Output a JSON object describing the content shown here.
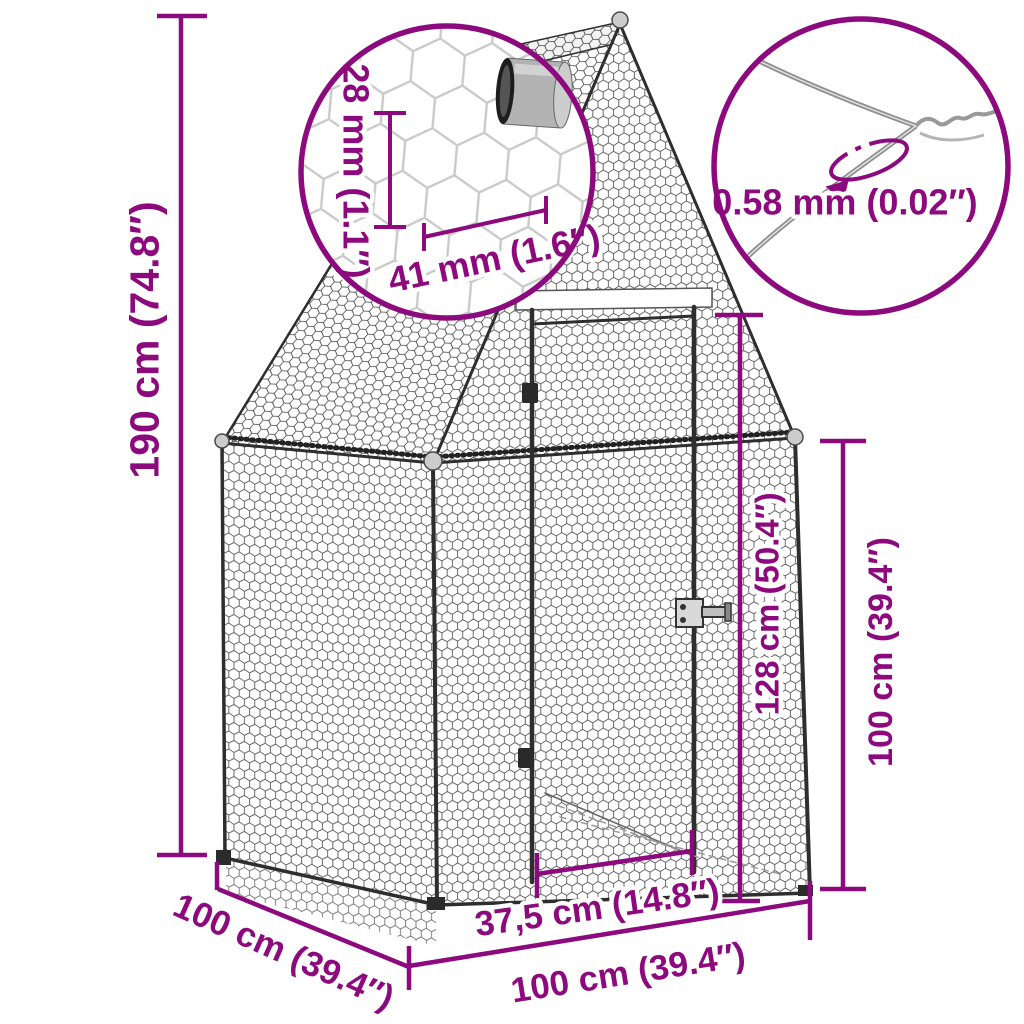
{
  "accent_color": "#8C0A7D",
  "callout_mesh": {
    "hole_height_label": "28 mm (1.1″)",
    "hole_width_label": "41 mm (1.6″)"
  },
  "callout_wire": {
    "diameter_label": "0.58 mm (0.02″)"
  },
  "dims": {
    "total_height": "190 cm (74.8″)",
    "door_height": "128 cm (50.4″)",
    "side_wall_height": "100 cm (39.4″)",
    "door_width": "37,5 cm (14.8″)",
    "front_width": "100 cm (39.4″)",
    "depth": "100 cm (39.4″)"
  }
}
